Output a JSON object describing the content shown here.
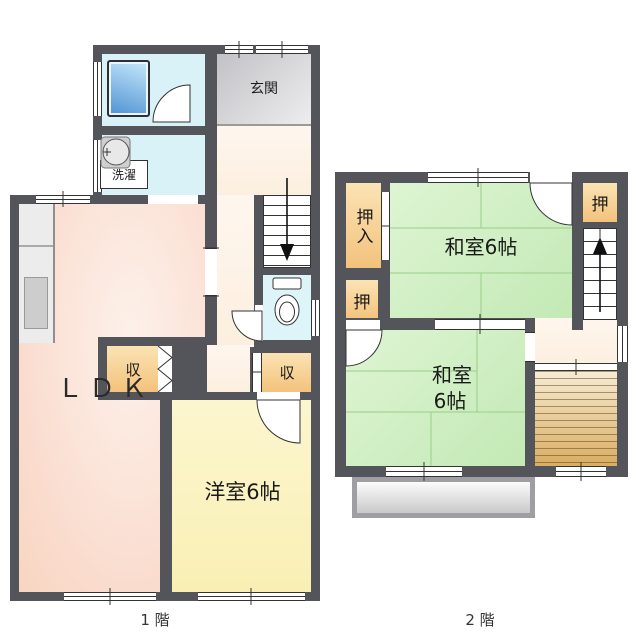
{
  "floor1": {
    "label": "1 階",
    "rooms": {
      "ldk": "ＬＤＫ",
      "western_room": "洋室6帖",
      "entrance": "玄関",
      "laundry": "洗濯",
      "storage_left": "収",
      "storage_right": "収"
    }
  },
  "floor2": {
    "label": "2 階",
    "rooms": {
      "oshiire": "押入",
      "oshi_top_right": "押",
      "oshi_left": "押",
      "tatami_upper": "和室6帖",
      "tatami_lower_line1": "和室",
      "tatami_lower_line2": "6帖"
    }
  },
  "colors": {
    "wall": "#54555b",
    "water_room": "#d9f2f8",
    "bathtub": "#5fa8dc",
    "entrance_floor": "#ededef",
    "hallway": "#fcefdf",
    "ldk": "#fadcce",
    "ldk_pale": "#fdf1ea",
    "western_room": "#f9efb4",
    "tatami_room": "#c3e9b5",
    "closet": "#f3c27c",
    "veranda": "#d9ad62",
    "balcony": "#c9c9c9"
  }
}
